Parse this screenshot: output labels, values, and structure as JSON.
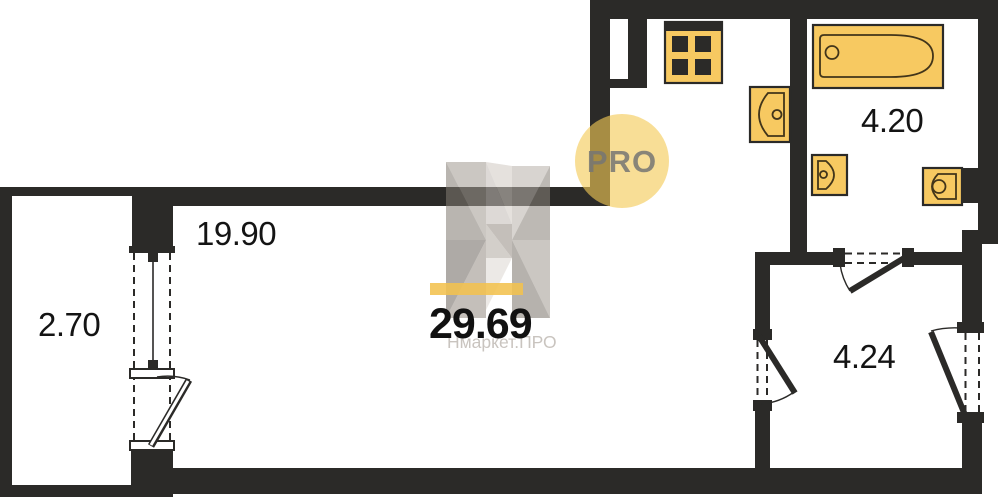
{
  "plan": {
    "total_area": "29.69",
    "rooms": {
      "living": {
        "label": "19.90"
      },
      "balcony": {
        "label": "2.70"
      },
      "bathroom": {
        "label": "4.20"
      },
      "hallway": {
        "label": "4.24"
      }
    },
    "watermark": {
      "badge": "PRO",
      "brand": "Нмаркет.ПРО"
    },
    "fixtures": [
      "bathtub",
      "stove",
      "kitchen-sink",
      "washbasin",
      "toilet"
    ],
    "colors": {
      "wall": "#2b2a28",
      "fixture_fill": "#f7c961",
      "accent_bar": "#f2c14e",
      "badge_circle": "#f4cb55",
      "badge_text": "#767673",
      "watermark_text": "#c9c4bf"
    }
  }
}
